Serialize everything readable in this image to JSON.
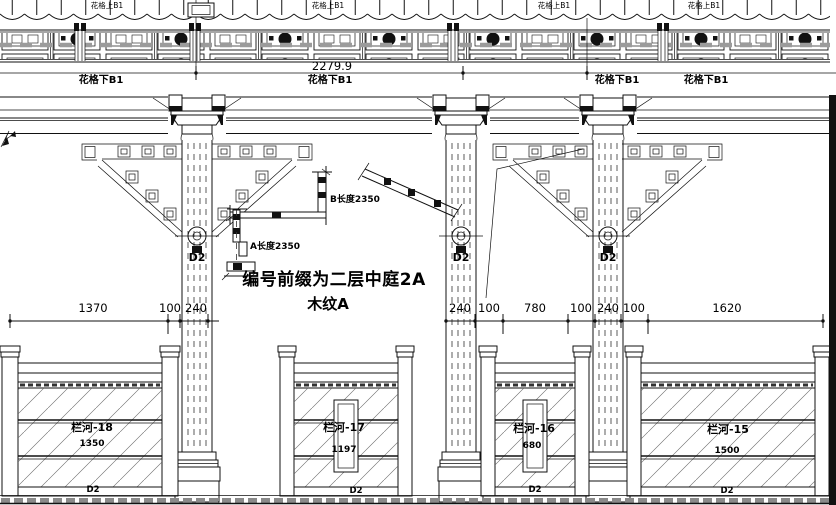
{
  "top_band": {
    "upper_label": "花格上B1",
    "lower_label": "花格下B1",
    "overall_dimension": "2279.9"
  },
  "annotations": {
    "detail_a_label": "A长度2350",
    "detail_b_label": "B长度2350",
    "title_line1": "编号前缀为二层中庭2A",
    "title_line2": "木纹A"
  },
  "columns": {
    "mark": "D2"
  },
  "dimensions": {
    "left": [
      "1370",
      "100",
      "240"
    ],
    "right": [
      "240",
      "100",
      "780",
      "100",
      "240",
      "100",
      "1620"
    ]
  },
  "panels": [
    {
      "name": "栏河-18",
      "length": "1350",
      "mark": "D2"
    },
    {
      "name": "栏河-17",
      "length": "1197",
      "mark": "D2"
    },
    {
      "name": "栏河-16",
      "length": "680",
      "mark": "D2"
    },
    {
      "name": "栏河-15",
      "length": "1500",
      "mark": "D2"
    }
  ]
}
